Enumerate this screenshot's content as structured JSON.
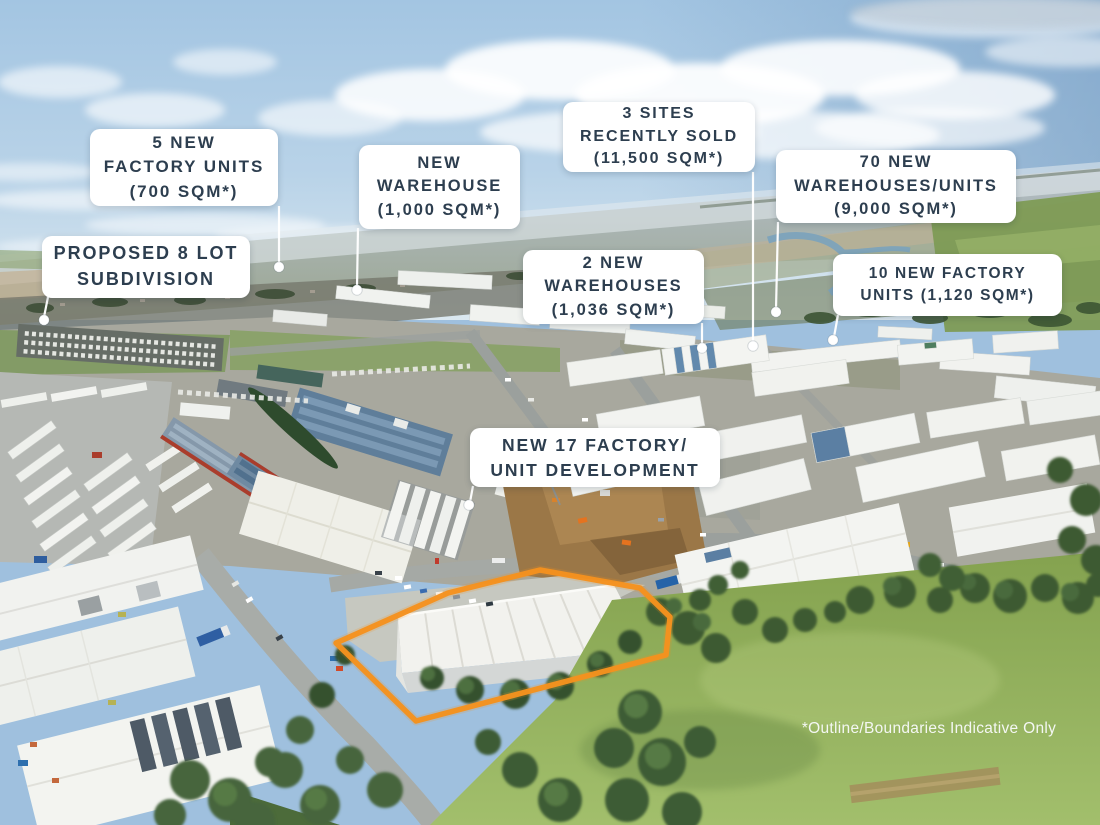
{
  "title": "Industrial estate aerial marketing image",
  "colors": {
    "outline": "#F5921E",
    "label_bg": "#FFFFFF",
    "label_text": "#2D3E4F",
    "leader": "#FFFFFF"
  },
  "callouts": [
    {
      "id": "factory-units-5",
      "text": "5 NEW\nFACTORY UNITS\n(700 SQM*)"
    },
    {
      "id": "proposed-subdivision",
      "text": "PROPOSED 8 LOT\nSUBDIVISION"
    },
    {
      "id": "new-warehouse",
      "text": "NEW\nWAREHOUSE\n(1,000 SQM*)"
    },
    {
      "id": "sites-recently-sold",
      "text": "3 SITES\nRECENTLY SOLD\n(11,500 SQM*)"
    },
    {
      "id": "warehouses-2",
      "text": "2 NEW\nWAREHOUSES\n(1,036 SQM*)"
    },
    {
      "id": "warehouses-70",
      "text": "70 NEW\nWAREHOUSES/UNITS\n(9,000 SQM*)"
    },
    {
      "id": "factory-units-10",
      "text": "10 NEW FACTORY\nUNITS (1,120 SQM*)"
    },
    {
      "id": "factory-unit-17-dev",
      "text": "NEW 17 FACTORY/\nUNIT DEVELOPMENT"
    }
  ],
  "footnote": "*Outline/Boundaries Indicative Only"
}
